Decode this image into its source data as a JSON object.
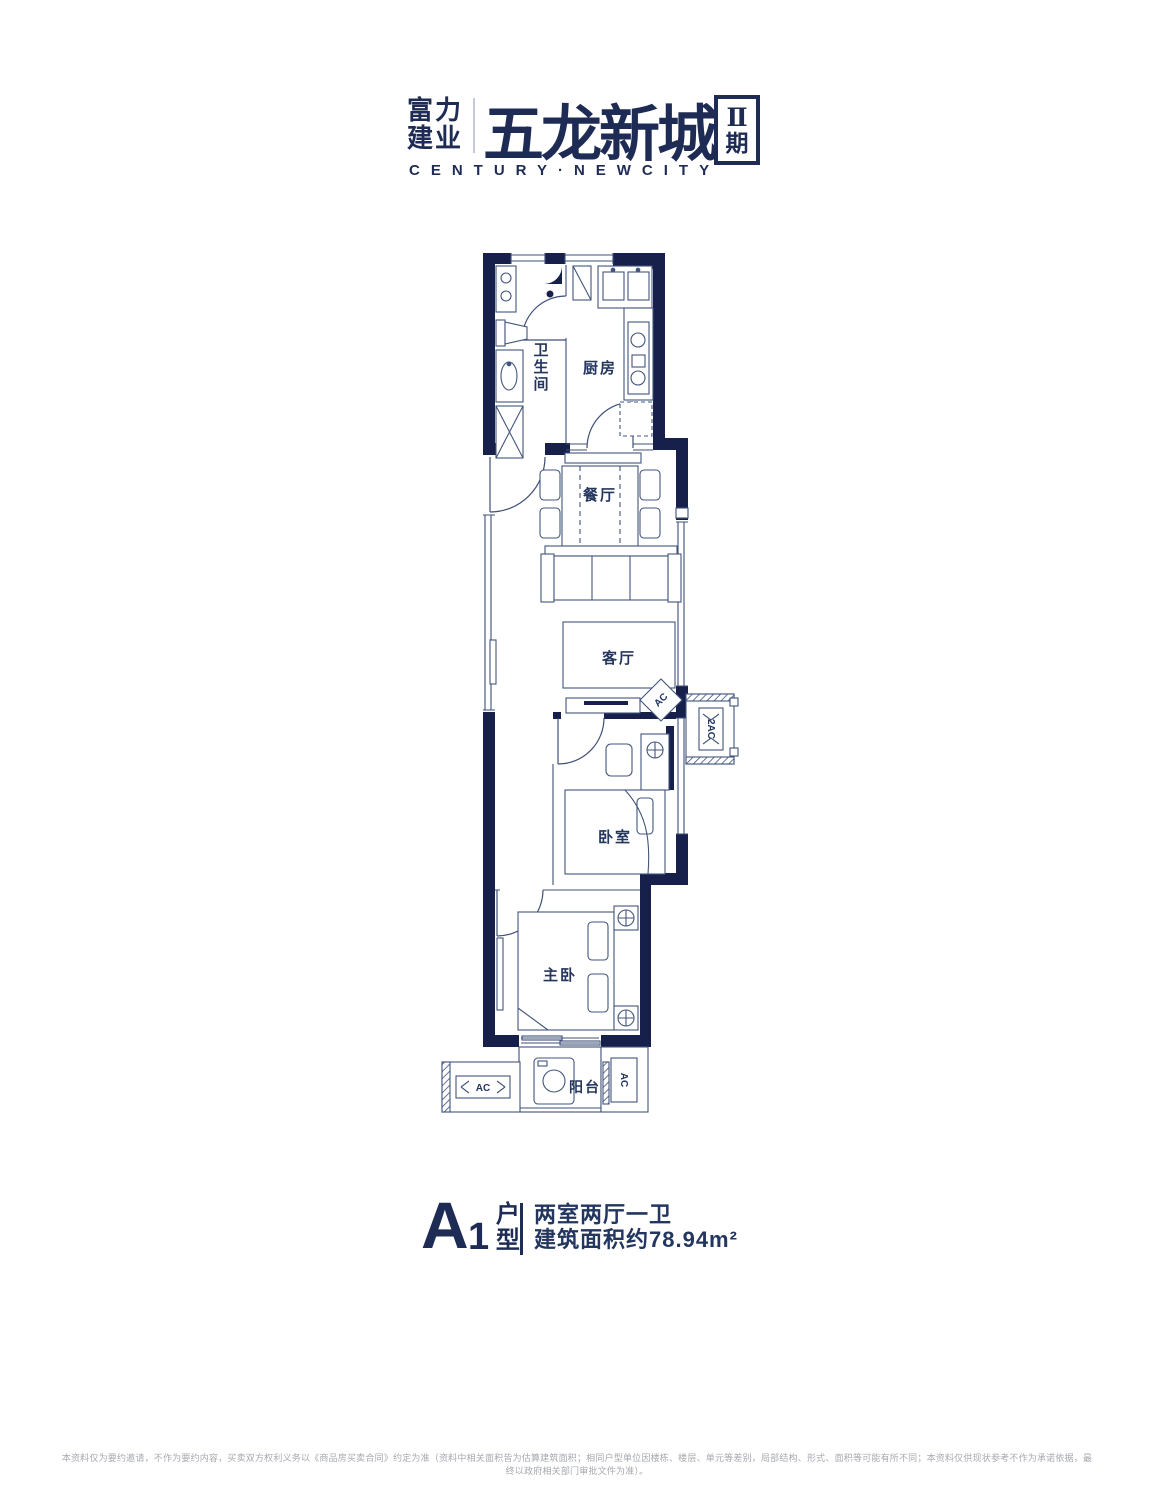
{
  "logo": {
    "brand_line1": "富力",
    "brand_line2": "建业",
    "project_name": "五龙新城",
    "phase_numeral": "Ⅱ",
    "phase_char": "期",
    "subtitle": "CENTURY·NEWCITY"
  },
  "plan": {
    "rooms": {
      "bathroom": "卫生间",
      "kitchen": "厨房",
      "dining": "餐厅",
      "living": "客厅",
      "bedroom": "卧室",
      "master": "主卧",
      "balcony": "阳台"
    },
    "equipment": {
      "ac_unit": "AC",
      "ac_platform_side": "2AC",
      "ac_platform_bottom_left": "AC",
      "ac_platform_bottom_right": "AC"
    }
  },
  "footer": {
    "unit_letter": "A",
    "unit_number": "1",
    "unit_suffix": "户型",
    "spec_line1": "两室两厅一卫",
    "spec_line2": "建筑面积约78.94m²"
  },
  "disclaimer": "本资料仅为要约邀请，不作为要约内容，买卖双方权利义务以《商品房买卖合同》约定为准（资料中相关面积皆为估算建筑面积；相同户型单位因楼栋、楼层、单元等差别，局部结构、形式、面积等可能有所不同；本资料仅供现状参考不作为承诺依据，最终以政府相关部门审批文件为准）。",
  "colors": {
    "wall_navy": "#16204a",
    "line_blue": "#3e5076",
    "label_navy": "#24365e",
    "logo_navy": "#1e2c55",
    "disclaimer_gray": "#a6a9b0"
  }
}
